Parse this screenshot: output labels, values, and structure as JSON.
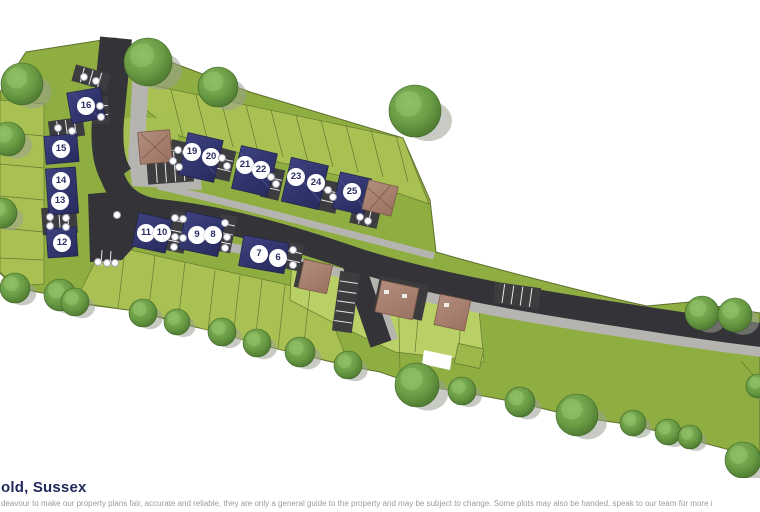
{
  "header": {
    "title": "old, Sussex"
  },
  "footer": {
    "disclaimer": "deavour to make our property plans fair, accurate and reliable, they are only a general guide to the property and may be subject to change. Some plots may also be handed, speak to our team for more i"
  },
  "colors": {
    "title_navy": "#232a5c",
    "disclaimer_gray": "#9b9b9b",
    "site_green": "#8fae41",
    "garden_green": "#a9c153",
    "existing_garden_green": "#b9d066",
    "road_dark": "#343438",
    "pavement_gray": "#b6b4b0",
    "roof_navy": "#2e3168",
    "roof_brown": "#a87e6d",
    "tree_green": "#699b44",
    "marker_bg": "#ffffff",
    "marker_text": "#2b2e63"
  },
  "site": {
    "plots": [
      {
        "number": "16",
        "x": 86,
        "y": 106
      },
      {
        "number": "15",
        "x": 61,
        "y": 149
      },
      {
        "number": "14",
        "x": 61,
        "y": 181
      },
      {
        "number": "13",
        "x": 60,
        "y": 201
      },
      {
        "number": "12",
        "x": 62,
        "y": 243
      },
      {
        "number": "11",
        "x": 146,
        "y": 233
      },
      {
        "number": "10",
        "x": 162,
        "y": 233
      },
      {
        "number": "9",
        "x": 197,
        "y": 235
      },
      {
        "number": "8",
        "x": 213,
        "y": 235
      },
      {
        "number": "7",
        "x": 259,
        "y": 254
      },
      {
        "number": "6",
        "x": 278,
        "y": 258
      },
      {
        "number": "19",
        "x": 192,
        "y": 152
      },
      {
        "number": "20",
        "x": 211,
        "y": 157
      },
      {
        "number": "21",
        "x": 245,
        "y": 165
      },
      {
        "number": "22",
        "x": 261,
        "y": 170
      },
      {
        "number": "23",
        "x": 296,
        "y": 177
      },
      {
        "number": "24",
        "x": 316,
        "y": 183
      },
      {
        "number": "25",
        "x": 352,
        "y": 192
      }
    ],
    "parking_dots": [
      {
        "x": 84,
        "y": 77
      },
      {
        "x": 96,
        "y": 81
      },
      {
        "x": 100,
        "y": 106
      },
      {
        "x": 101,
        "y": 117
      },
      {
        "x": 58,
        "y": 128
      },
      {
        "x": 72,
        "y": 131
      },
      {
        "x": 50,
        "y": 217
      },
      {
        "x": 66,
        "y": 218
      },
      {
        "x": 50,
        "y": 226
      },
      {
        "x": 66,
        "y": 227
      },
      {
        "x": 98,
        "y": 262
      },
      {
        "x": 107,
        "y": 263
      },
      {
        "x": 115,
        "y": 263
      },
      {
        "x": 178,
        "y": 150
      },
      {
        "x": 173,
        "y": 161
      },
      {
        "x": 179,
        "y": 167
      },
      {
        "x": 222,
        "y": 158
      },
      {
        "x": 227,
        "y": 166
      },
      {
        "x": 271,
        "y": 177
      },
      {
        "x": 276,
        "y": 184
      },
      {
        "x": 328,
        "y": 190
      },
      {
        "x": 333,
        "y": 197
      },
      {
        "x": 360,
        "y": 217
      },
      {
        "x": 368,
        "y": 221
      },
      {
        "x": 117,
        "y": 215
      },
      {
        "x": 175,
        "y": 218
      },
      {
        "x": 183,
        "y": 219
      },
      {
        "x": 175,
        "y": 237
      },
      {
        "x": 183,
        "y": 238
      },
      {
        "x": 174,
        "y": 247
      },
      {
        "x": 225,
        "y": 223
      },
      {
        "x": 227,
        "y": 237
      },
      {
        "x": 225,
        "y": 248
      },
      {
        "x": 293,
        "y": 250
      },
      {
        "x": 293,
        "y": 265
      }
    ],
    "parking_rows": [
      {
        "x": 73,
        "y": 69,
        "w": 36,
        "h": 17,
        "rot": 16
      },
      {
        "x": 92,
        "y": 97,
        "w": 17,
        "h": 27,
        "rot": -4
      },
      {
        "x": 49,
        "y": 119,
        "w": 35,
        "h": 19,
        "rot": -8
      },
      {
        "x": 42,
        "y": 207,
        "w": 35,
        "h": 27,
        "rot": -4
      },
      {
        "x": 168,
        "y": 141,
        "w": 20,
        "h": 32,
        "rot": 13
      },
      {
        "x": 214,
        "y": 149,
        "w": 19,
        "h": 31,
        "rot": 13
      },
      {
        "x": 263,
        "y": 168,
        "w": 19,
        "h": 31,
        "rot": 13
      },
      {
        "x": 320,
        "y": 181,
        "w": 19,
        "h": 31,
        "rot": 13
      },
      {
        "x": 351,
        "y": 207,
        "w": 28,
        "h": 19,
        "rot": 13
      },
      {
        "x": 167,
        "y": 211,
        "w": 21,
        "h": 41,
        "rot": 12
      },
      {
        "x": 217,
        "y": 215,
        "w": 17,
        "h": 37,
        "rot": 12
      },
      {
        "x": 285,
        "y": 243,
        "w": 17,
        "h": 27,
        "rot": 12
      },
      {
        "x": 494,
        "y": 285,
        "w": 46,
        "h": 21,
        "rot": 8
      },
      {
        "x": 147,
        "y": 151,
        "w": 46,
        "h": 32,
        "rot": -4
      },
      {
        "x": 336,
        "y": 272,
        "w": 20,
        "h": 60,
        "rot": 8
      }
    ],
    "trees": [
      {
        "x": 148,
        "y": 62,
        "r": 24
      },
      {
        "x": 218,
        "y": 87,
        "r": 20
      },
      {
        "x": 415,
        "y": 111,
        "r": 26
      },
      {
        "x": 22,
        "y": 84,
        "r": 21
      },
      {
        "x": 8,
        "y": 139,
        "r": 17
      },
      {
        "x": 2,
        "y": 213,
        "r": 15
      },
      {
        "x": 15,
        "y": 288,
        "r": 15
      },
      {
        "x": 60,
        "y": 295,
        "r": 16
      },
      {
        "x": 75,
        "y": 302,
        "r": 14
      },
      {
        "x": 143,
        "y": 313,
        "r": 14
      },
      {
        "x": 177,
        "y": 322,
        "r": 13
      },
      {
        "x": 222,
        "y": 332,
        "r": 14
      },
      {
        "x": 257,
        "y": 343,
        "r": 14
      },
      {
        "x": 300,
        "y": 352,
        "r": 15
      },
      {
        "x": 348,
        "y": 365,
        "r": 14
      },
      {
        "x": 417,
        "y": 385,
        "r": 22
      },
      {
        "x": 462,
        "y": 391,
        "r": 14
      },
      {
        "x": 520,
        "y": 402,
        "r": 15
      },
      {
        "x": 577,
        "y": 415,
        "r": 21
      },
      {
        "x": 633,
        "y": 423,
        "r": 13
      },
      {
        "x": 668,
        "y": 432,
        "r": 13
      },
      {
        "x": 690,
        "y": 437,
        "r": 12
      },
      {
        "x": 743,
        "y": 460,
        "r": 18
      },
      {
        "x": 758,
        "y": 386,
        "r": 12
      },
      {
        "x": 702,
        "y": 313,
        "r": 17
      },
      {
        "x": 735,
        "y": 315,
        "r": 17
      }
    ]
  }
}
